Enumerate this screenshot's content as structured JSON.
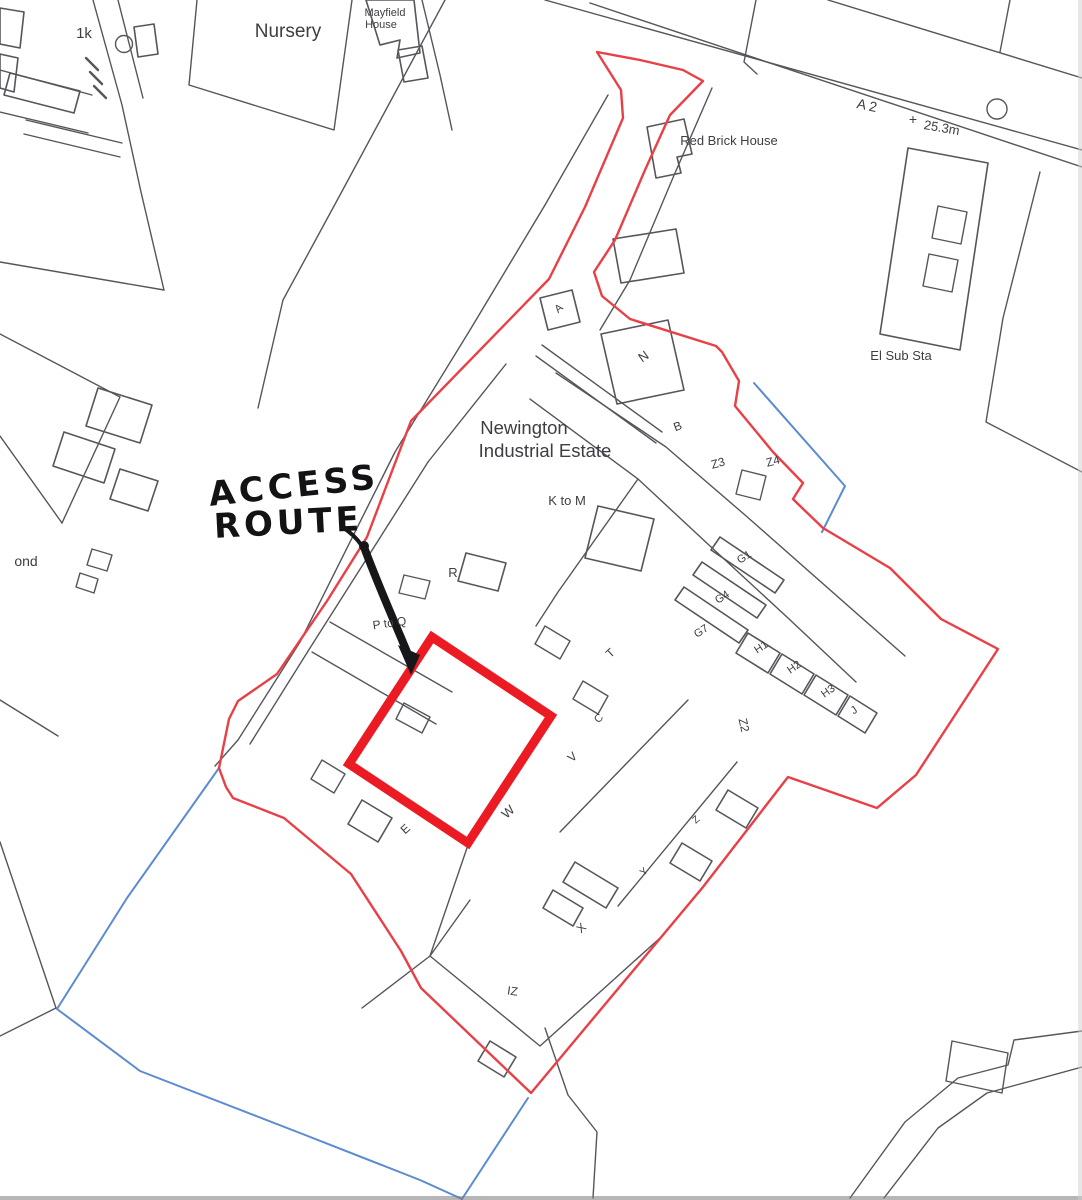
{
  "page": {
    "type": "scanned site location plan",
    "estate_name": "Newington Industrial Estate"
  },
  "colors": {
    "site_boundary_red": "#e84046",
    "highlight_square_red": "#ec1a23",
    "secondary_boundary_blue": "#5b8bd0",
    "map_linework_gray": "#55565c",
    "handwriting_ink": "#131316",
    "paper": "#ffffff"
  },
  "annotation": {
    "line1": "ACCESS",
    "line2": "ROUTE"
  },
  "map_labels": [
    {
      "text": "ACCESS",
      "x": 295,
      "y": 497,
      "rot": -6,
      "size": 34,
      "cls": "hand",
      "name": "access-route-annotation-line1"
    },
    {
      "text": "ROUTE",
      "x": 289,
      "y": 534,
      "rot": -3,
      "size": 34,
      "cls": "hand",
      "name": "access-route-annotation-line2"
    },
    {
      "text": "1k",
      "x": 84,
      "y": 38,
      "rot": 0,
      "size": 15,
      "name": "label-1k"
    },
    {
      "text": "Nursery",
      "x": 288,
      "y": 37,
      "rot": 0,
      "size": 19,
      "name": "label-nursery"
    },
    {
      "text": "Mayfield",
      "x": 385,
      "y": 16,
      "rot": 0,
      "size": 11,
      "name": "label-mayfield-house"
    },
    {
      "text": "House",
      "x": 381,
      "y": 28,
      "rot": 0,
      "size": 11,
      "name": "label-mayfield-house"
    },
    {
      "text": "A 2",
      "x": 866,
      "y": 110,
      "rot": 12,
      "size": 14,
      "name": "label-a2-road"
    },
    {
      "text": "+",
      "x": 913,
      "y": 124,
      "rot": 0,
      "size": 14,
      "name": "benchmark-cross"
    },
    {
      "text": "25.3m",
      "x": 941,
      "y": 132,
      "rot": 10,
      "size": 13,
      "name": "label-spot-height"
    },
    {
      "text": "Red Brick House",
      "x": 729,
      "y": 145,
      "rot": 0,
      "size": 13,
      "name": "label-red-brick-house"
    },
    {
      "text": "El Sub Sta",
      "x": 901,
      "y": 360,
      "rot": 0,
      "size": 13,
      "name": "label-el-sub-sta"
    },
    {
      "text": "Newington",
      "x": 524,
      "y": 434,
      "rot": 0,
      "size": 18.5,
      "name": "label-estate-name"
    },
    {
      "text": "Industrial Estate",
      "x": 545,
      "y": 457,
      "rot": 0,
      "size": 18.5,
      "name": "label-estate-name"
    },
    {
      "text": "K to M",
      "x": 567,
      "y": 505,
      "rot": 0,
      "size": 13,
      "name": "label-unit-k-to-m"
    },
    {
      "text": "N",
      "x": 646,
      "y": 360,
      "rot": -35,
      "size": 13,
      "name": "label-unit-n"
    },
    {
      "text": "A",
      "x": 561,
      "y": 311,
      "rot": -40,
      "size": 11,
      "name": "label-unit-a"
    },
    {
      "text": "B",
      "x": 679,
      "y": 430,
      "rot": -20,
      "size": 12,
      "name": "label-unit-b"
    },
    {
      "text": "Z3",
      "x": 719,
      "y": 467,
      "rot": -15,
      "size": 12,
      "name": "label-unit-z3"
    },
    {
      "text": "Z4",
      "x": 774,
      "y": 465,
      "rot": -15,
      "size": 12,
      "name": "label-unit-z4"
    },
    {
      "text": "G1",
      "x": 746,
      "y": 560,
      "rot": -33,
      "size": 11,
      "name": "label-unit-g1"
    },
    {
      "text": "G4",
      "x": 724,
      "y": 600,
      "rot": -33,
      "size": 11,
      "name": "label-unit-g4"
    },
    {
      "text": "G7",
      "x": 703,
      "y": 634,
      "rot": -33,
      "size": 11,
      "name": "label-unit-g7"
    },
    {
      "text": "H1",
      "x": 763,
      "y": 650,
      "rot": -33,
      "size": 11,
      "name": "label-unit-h1"
    },
    {
      "text": "H2",
      "x": 796,
      "y": 670,
      "rot": -35,
      "size": 11,
      "name": "label-unit-h2"
    },
    {
      "text": "H3",
      "x": 830,
      "y": 694,
      "rot": -35,
      "size": 11,
      "name": "label-unit-h3"
    },
    {
      "text": "J",
      "x": 856,
      "y": 713,
      "rot": -35,
      "size": 11,
      "name": "label-unit-j"
    },
    {
      "text": "Z2",
      "x": 740,
      "y": 726,
      "rot": 78,
      "size": 12,
      "name": "label-unit-z2"
    },
    {
      "text": "R",
      "x": 453,
      "y": 577,
      "rot": 0,
      "size": 13,
      "name": "label-unit-r"
    },
    {
      "text": "P to Q",
      "x": 390,
      "y": 627,
      "rot": -8,
      "size": 12,
      "name": "label-unit-p-to-q"
    },
    {
      "text": "T",
      "x": 613,
      "y": 656,
      "rot": -42,
      "size": 12,
      "name": "label-unit-t"
    },
    {
      "text": "C",
      "x": 601,
      "y": 721,
      "rot": -42,
      "size": 11,
      "name": "label-unit-c"
    },
    {
      "text": "V",
      "x": 575,
      "y": 760,
      "rot": -42,
      "size": 12,
      "name": "label-unit-v"
    },
    {
      "text": "W",
      "x": 511,
      "y": 815,
      "rot": -42,
      "size": 13,
      "name": "label-unit-w"
    },
    {
      "text": "E",
      "x": 408,
      "y": 832,
      "rot": -42,
      "size": 12,
      "name": "label-unit-e"
    },
    {
      "text": "Z",
      "x": 698,
      "y": 822,
      "rot": -42,
      "size": 10,
      "name": "label-unit-z"
    },
    {
      "text": "Y",
      "x": 646,
      "y": 874,
      "rot": -42,
      "size": 10,
      "name": "label-unit-y"
    },
    {
      "text": "X",
      "x": 584,
      "y": 931,
      "rot": -42,
      "size": 12,
      "name": "label-unit-x"
    },
    {
      "text": "IZ",
      "x": 512,
      "y": 995,
      "rot": 8,
      "size": 12,
      "name": "label-unit-iz"
    },
    {
      "text": "ond",
      "x": 26,
      "y": 566,
      "rot": 0,
      "size": 14,
      "name": "label-pond-partial"
    }
  ]
}
